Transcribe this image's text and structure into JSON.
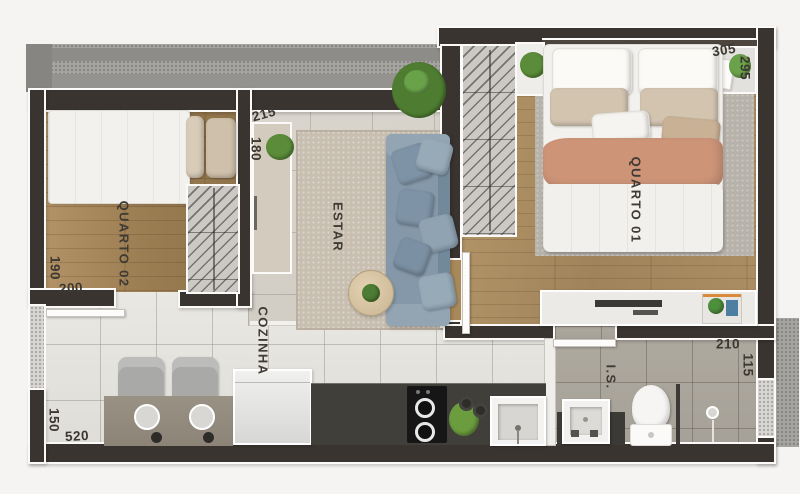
{
  "plan": {
    "type": "apartment-floor-plan",
    "rooms": [
      {
        "id": "quarto02",
        "label": "QUARTO 02"
      },
      {
        "id": "estar",
        "label": "ESTAR"
      },
      {
        "id": "quarto01",
        "label": "QUARTO 01"
      },
      {
        "id": "cozinha",
        "label": "COZINHA"
      },
      {
        "id": "is",
        "label": "I.S."
      }
    ],
    "dimensions": [
      {
        "id": "hall-width",
        "value": "215"
      },
      {
        "id": "hall-depth",
        "value": "180"
      },
      {
        "id": "quarto02-depth",
        "value": "190"
      },
      {
        "id": "quarto02-width",
        "value": "200"
      },
      {
        "id": "cozinha-depth",
        "value": "150"
      },
      {
        "id": "cozinha-width",
        "value": "520"
      },
      {
        "id": "quarto01-width",
        "value": "305"
      },
      {
        "id": "quarto01-depth",
        "value": "295"
      },
      {
        "id": "is-width",
        "value": "210"
      },
      {
        "id": "is-depth",
        "value": "115"
      }
    ],
    "palette": {
      "wall": "#3a3430",
      "wall_outline": "#fbfaf8",
      "wood_floor": "#a0835a",
      "living_tile": "#d5d1c9",
      "kitchen_tile": "#e5e3de",
      "bath_tile": "#aba69e",
      "sofa_blue": "#8498a9",
      "blanket_salmon": "#cd9478",
      "rug_beige": "#c8bfb1",
      "counter_dark": "#413f3a",
      "plant_green": "#5a8c39",
      "label_text": "#3f3a33"
    }
  }
}
